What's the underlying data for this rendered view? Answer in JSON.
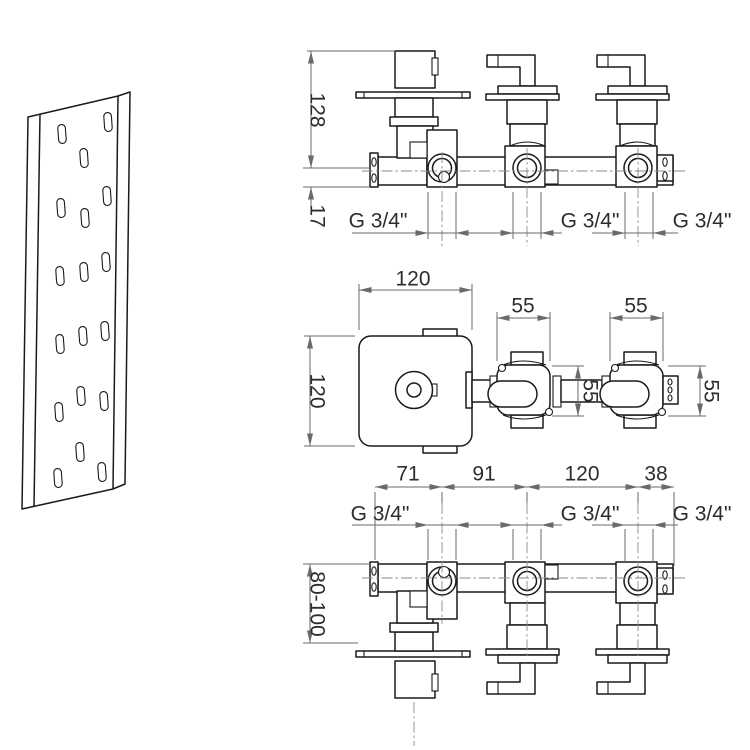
{
  "drawing_type": "technical-installation-drawing",
  "product": "concealed-thermostatic-3-way-valve",
  "colors": {
    "edge": "#1a1a1a",
    "dimension": "#6a6a6a",
    "label": "#2d2d2d",
    "background": "#ffffff"
  },
  "views": {
    "front": {
      "dim_height": "128",
      "dim_axis_offset": "17",
      "threads": [
        "G 3/4\"",
        "G 3/4\"",
        "G 3/4\""
      ]
    },
    "plan": {
      "dim_plate_width": "120",
      "dim_plate_height": "120",
      "dim_valve_widths": [
        "55",
        "55"
      ],
      "dim_body_depth": "55",
      "dim_valve_height": "55"
    },
    "install": {
      "dim_chain": [
        "71",
        "91",
        "120",
        "38"
      ],
      "threads": [
        "G 3/4\"",
        "G 3/4\"",
        "G 3/4\""
      ],
      "dim_depth_range": "80-100"
    }
  }
}
